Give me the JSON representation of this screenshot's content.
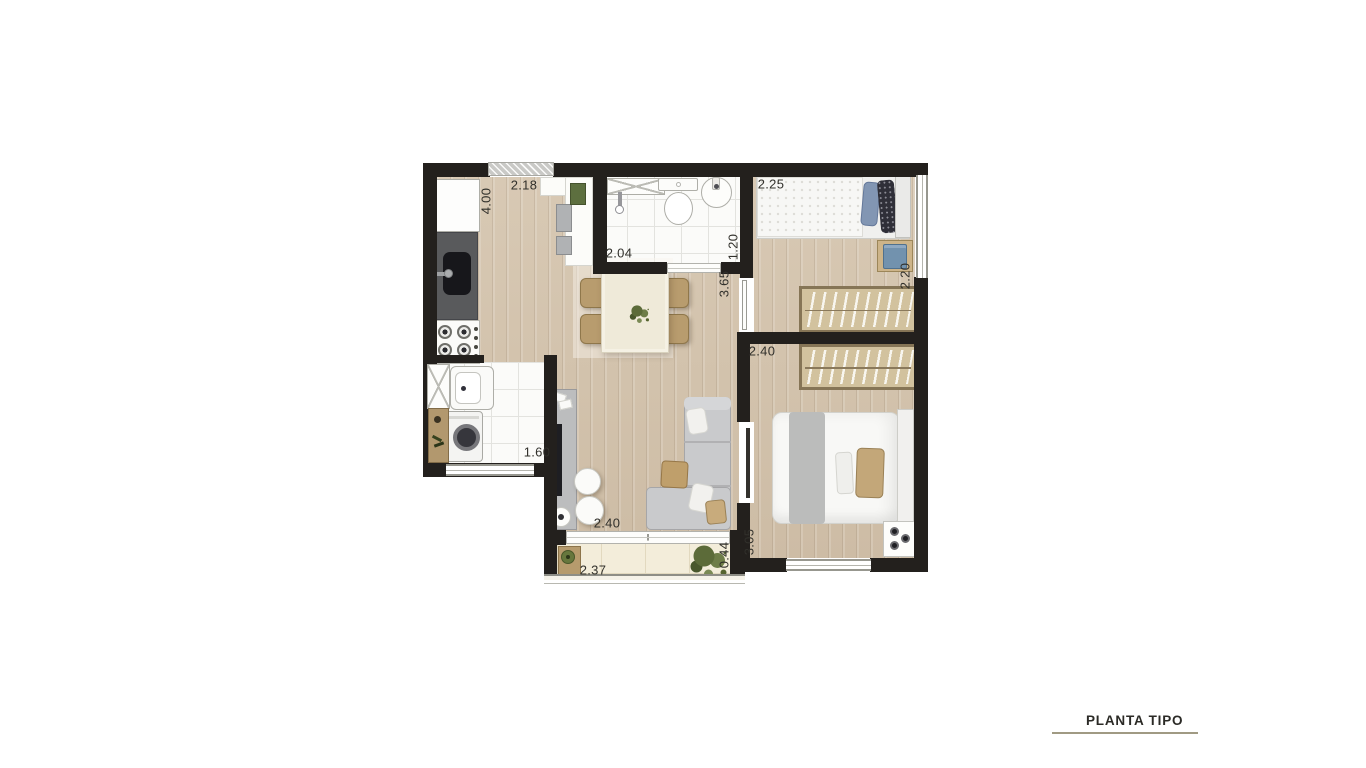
{
  "plan": {
    "title": "PLANTA TIPO",
    "colors": {
      "wall": "#23201d",
      "wood_floor": "#d3c3ad",
      "tile_floor": "#fbfbf9",
      "balcony_floor": "#f3edda",
      "counter": "#595a5c",
      "wardrobe": "#d2c29e",
      "sofa": "#c9cacc",
      "chair_tan": "#b89c6e",
      "plant_green": "#5c6b39",
      "title_underline": "#a09a83",
      "dim_text": "#31302b"
    },
    "dimensions": [
      {
        "id": "kitchen-width",
        "text": "2.18"
      },
      {
        "id": "kitchen-length",
        "text": "4.00"
      },
      {
        "id": "bathroom-width",
        "text": "2.04"
      },
      {
        "id": "bathroom-depth",
        "text": "1.20"
      },
      {
        "id": "bedroom2-width",
        "text": "2.25"
      },
      {
        "id": "bedroom2-depth",
        "text": "2.20"
      },
      {
        "id": "living-length",
        "text": "3.65"
      },
      {
        "id": "bedroom1-width",
        "text": "2.40"
      },
      {
        "id": "living-width",
        "text": "2.40"
      },
      {
        "id": "laundry-width",
        "text": "1.60"
      },
      {
        "id": "balcony-width",
        "text": "2.37"
      },
      {
        "id": "balcony-depth",
        "text": "0.44"
      },
      {
        "id": "bedroom1-length",
        "text": "3.05"
      }
    ]
  }
}
